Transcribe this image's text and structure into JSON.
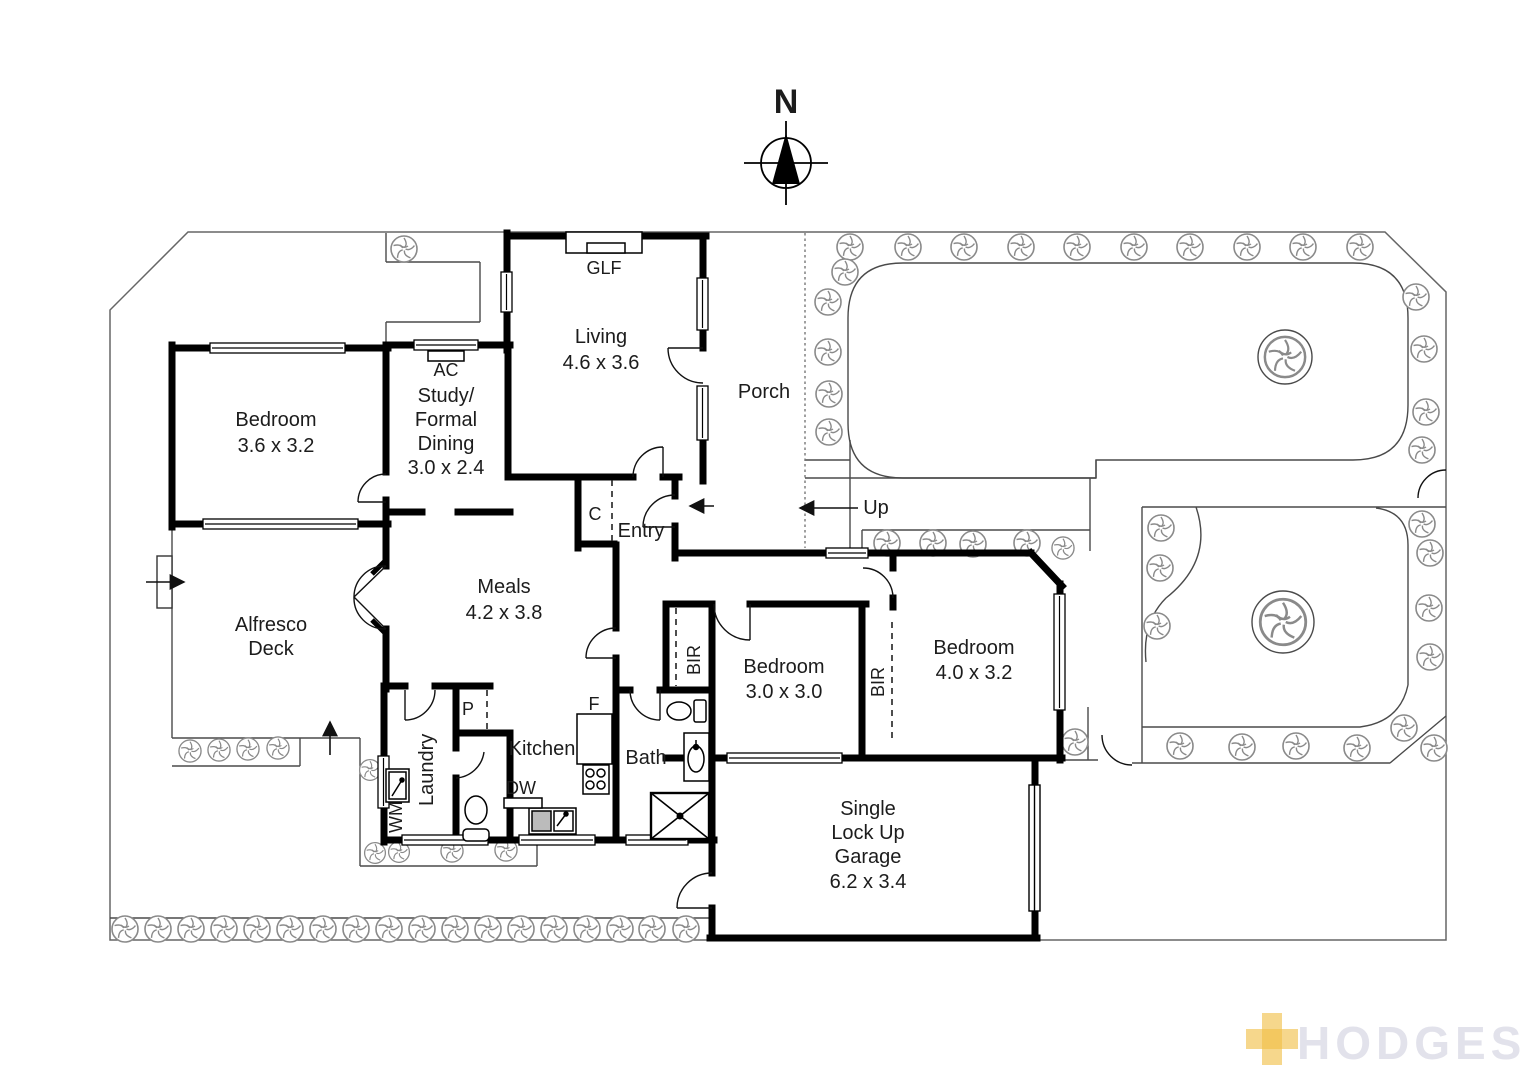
{
  "compass": {
    "north_label": "N"
  },
  "rooms": {
    "bedroom_nw": {
      "name": "Bedroom",
      "dims": "3.6 x 3.2"
    },
    "study": {
      "line1": "Study/",
      "line2": "Formal",
      "line3": "Dining",
      "dims": "3.0 x 2.4"
    },
    "living": {
      "name": "Living",
      "dims": "4.6 x 3.6"
    },
    "porch": {
      "name": "Porch"
    },
    "entry": {
      "name": "Entry"
    },
    "meals": {
      "name": "Meals",
      "dims": "4.2 x 3.8"
    },
    "alfresco": {
      "line1": "Alfresco",
      "line2": "Deck"
    },
    "laundry": {
      "name": "Laundry"
    },
    "kitchen": {
      "name": "Kitchen"
    },
    "bath": {
      "name": "Bath"
    },
    "bedroom_mid": {
      "name": "Bedroom",
      "dims": "3.0 x 3.0"
    },
    "bedroom_east": {
      "name": "Bedroom",
      "dims": "4.0 x 3.2"
    },
    "garage": {
      "line1": "Single",
      "line2": "Lock Up",
      "line3": "Garage",
      "dims": "6.2 x 3.4"
    }
  },
  "fixtures": {
    "fireplace": "GLF",
    "air_conditioner": "AC",
    "closet": "C",
    "pantry": "P",
    "fridge": "F",
    "dishwasher": "DW",
    "washing_machine": "WM",
    "built_in_robe_1": "BIR",
    "built_in_robe_2": "BIR",
    "stairs_up": "Up"
  },
  "watermark": {
    "brand": "HODGES"
  },
  "colors": {
    "wall": "#000000",
    "boundary": "#666666",
    "thin_line": "#4a4a4a",
    "vegetation": "#8a8a8a",
    "label": "#1c1c1c",
    "watermark_text": "#c6c6d8",
    "watermark_plus": "#efb743"
  }
}
